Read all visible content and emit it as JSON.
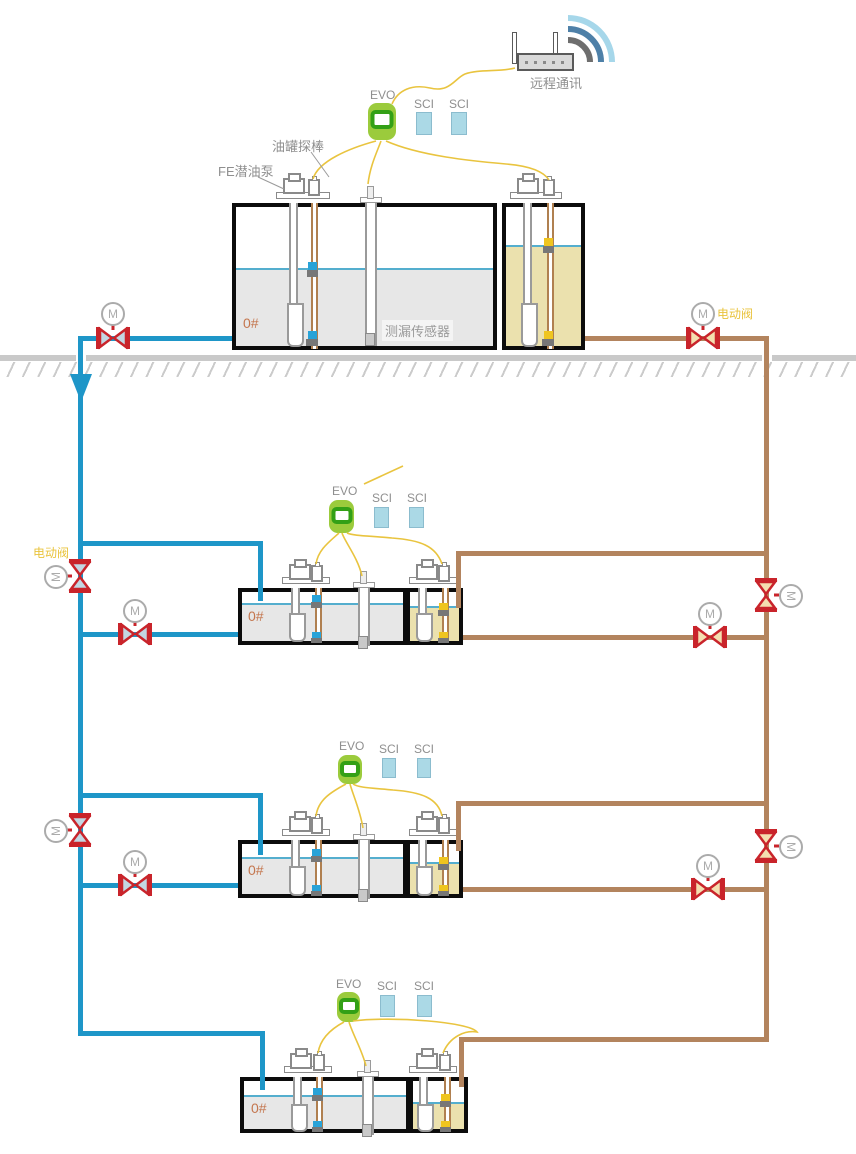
{
  "diagram_title": "fuel-station-tank-monitoring-schematic",
  "labels": {
    "remote_comm": "远程通讯",
    "controller": "EVO",
    "module": "SCI",
    "tank_probe": "油罐探棒",
    "submersible_pump": "FE潜油泵",
    "leak_sensor": "测漏传感器",
    "motor_valve": "电动阀",
    "motor_letter": "M"
  },
  "stations": [
    {
      "id": "above-ground-tank",
      "fuel_grade": "0#"
    },
    {
      "id": "underground-tank-1",
      "fuel_grade": "0#"
    },
    {
      "id": "underground-tank-2",
      "fuel_grade": "0#"
    },
    {
      "id": "underground-tank-3",
      "fuel_grade": "0#"
    }
  ],
  "colors": {
    "supply_pipe_blue": "#1E96C8",
    "return_pipe_brown": "#B3845E",
    "valve_red": "#C9242B",
    "valve_fill_blue_line": "#C3D7E3",
    "valve_fill_brown_line": "#F4DFB0",
    "wire_yellow": "#E9C43F",
    "evo_green": "#9BCB3C",
    "evo_screen_green": "#33A016",
    "sci_blue": "#ABD9E6",
    "diesel_liquid_gray": "#E7E7E7",
    "gasoline_liquid_tan": "#EBE1AE",
    "liquid_surface_blue": "#54AECE",
    "float_blue": "#29A3D8",
    "float_yellow": "#EFC51F",
    "grade_text": "#C4764E",
    "valve_label_gold": "#E9C33C",
    "ground_gray": "#C9C9C9",
    "wifi_arc_outer": "#A6D7EA",
    "wifi_arc_mid": "#4E80A8",
    "wifi_arc_inner": "#6E6E6E"
  }
}
